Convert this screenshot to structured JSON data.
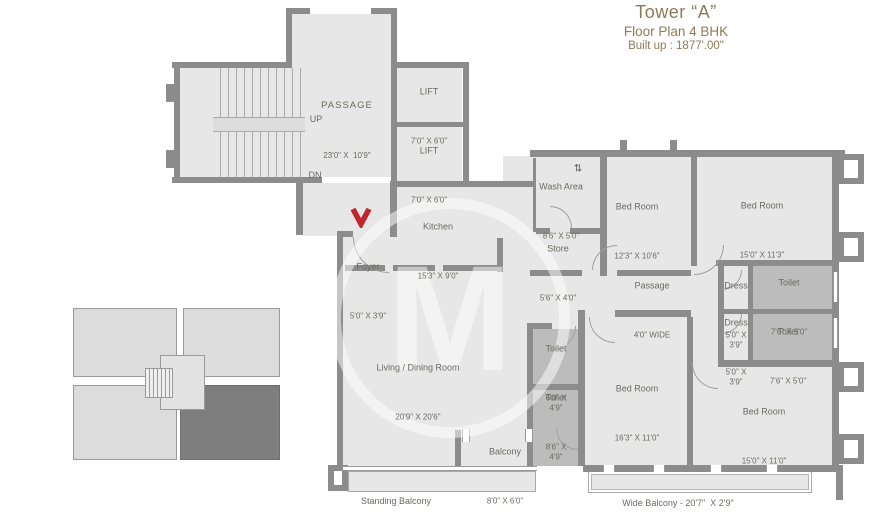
{
  "header": {
    "title": "Tower “A”",
    "subtitle": "Floor Plan 4 BHK",
    "builtup": "Built up : 1877'.00\""
  },
  "core": {
    "passage": {
      "name": "PASSAGE",
      "dims": "23'0\" X  10'9\""
    },
    "up": "UP",
    "dn": "DN",
    "lift_upper": {
      "name": "LIFT",
      "dims": "7'0\" X 6'0\""
    },
    "lift_lower": {
      "name": "LIFT",
      "dims": "7'0\" X 6'0\""
    }
  },
  "rooms": {
    "foyer": {
      "name": "Foyer",
      "dims": "5'0\" X 3'9\""
    },
    "kitchen": {
      "name": "Kitchen",
      "dims": "15'3\" X 9'0\""
    },
    "wash": {
      "name": "Wash Area",
      "dims": "8'6\" X 5'0\""
    },
    "store": {
      "name": "Store",
      "dims": "5'6\" X 4'0\""
    },
    "bedroom1": {
      "name": "Bed Room",
      "dims": "12'3\" X 10'6\""
    },
    "bedroom2": {
      "name": "Bed Room",
      "dims": "15'0\" X 11'3\""
    },
    "inner_passage": {
      "name": "Passage",
      "dims": "4'0\" WIDE"
    },
    "dress1": {
      "name": "Dress",
      "dims": "5'0\" X 3'9\""
    },
    "dress2": {
      "name": "Dress",
      "dims": "5'0\" X 3'9\""
    },
    "toilet1": {
      "name": "Toilet",
      "dims": "7'6\" X 5'0\""
    },
    "toilet2": {
      "name": "Toilet",
      "dims": "7'6\" X 5'0\""
    },
    "toilet3": {
      "name": "Toilet",
      "dims": "6'0\" X 4'9\""
    },
    "toilet4": {
      "name": "Toilet",
      "dims": "8'6\" X 4'9\""
    },
    "living": {
      "name": "Living / Dining Room",
      "dims": "20'9\" X 20'6\""
    },
    "bedroom3": {
      "name": "Bed Room",
      "dims": "16'3\" X 11'0\""
    },
    "bedroom4": {
      "name": "Bed Room",
      "dims": "15'0\" X 11'0\""
    },
    "balcony": {
      "name": "Balcony",
      "dims": "8'0\" X 6'0\""
    },
    "standing_balcony": {
      "name": "Standing Balcony"
    },
    "wide_balcony": {
      "name": "Wide Balcony - 20'7\"  X 2'9\""
    }
  },
  "icons": {
    "wash_arrows": "⇅"
  },
  "watermark": {
    "letter": "M"
  },
  "colors": {
    "wall": "#8c8c8c",
    "floor": "#e7e7e7",
    "toilet_fill": "#bcbcbc",
    "label_text": "#6b6a63",
    "title_text": "#8d7b58",
    "keyplan_highlight": "#7e7e7e",
    "entry_arrow": "#c0272d"
  }
}
